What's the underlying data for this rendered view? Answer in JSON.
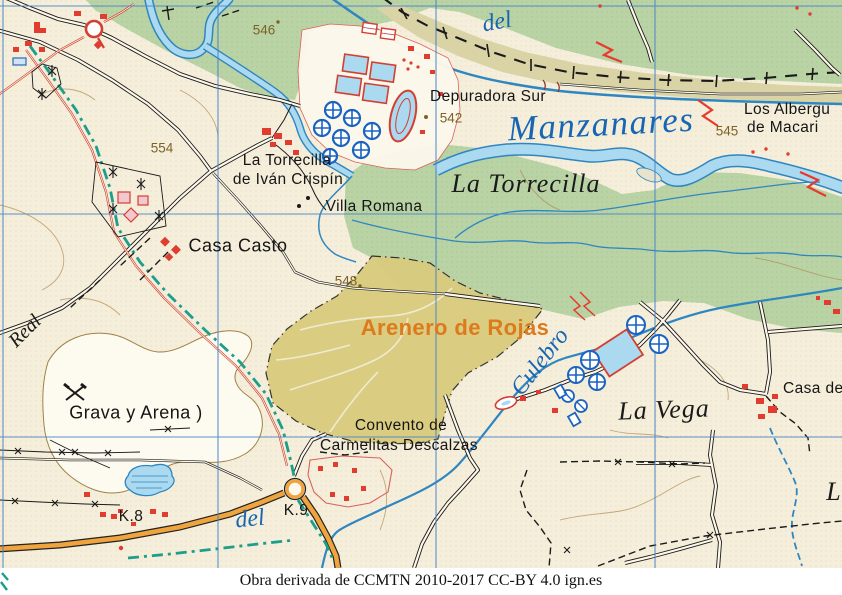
{
  "caption": "Obra derivada de CCMTN 2010-2017 CC-BY 4.0 ign.es",
  "map": {
    "colors": {
      "grid_blue": "#4a86c8",
      "forest_green": "#b9d3a5",
      "scrub_khaki": "#d9d3a6",
      "water_fill": "#abd9ef",
      "water_edge": "#2f86c0",
      "arenero_yellow": "#d8ca7c",
      "road_orange": "#f0a43e",
      "building_red": "#e03c30",
      "via_pecuaria_teal": "#1d9e8a",
      "label_brown": "#7d6228",
      "hydro_blue": "#1766b3",
      "arenero_label_orange": "#dd7a1c"
    },
    "labels": [
      {
        "id": "elev-546",
        "t": "546",
        "x": 264,
        "y": 30,
        "c": "elev"
      },
      {
        "id": "elev-554",
        "t": "554",
        "x": 162,
        "y": 148,
        "c": "elev"
      },
      {
        "id": "elev-542",
        "t": "542",
        "x": 451,
        "y": 118,
        "c": "elev"
      },
      {
        "id": "elev-545",
        "t": "545",
        "x": 727,
        "y": 131,
        "c": "elev"
      },
      {
        "id": "elev-548",
        "t": "548",
        "x": 346,
        "y": 281,
        "c": "elev"
      },
      {
        "id": "depuradora-sur",
        "t": "Depuradora Sur",
        "x": 488,
        "y": 97,
        "c": "topo"
      },
      {
        "id": "la-torrecilla-caserio",
        "t": "La Torrecilla",
        "x": 287,
        "y": 161,
        "c": "topo"
      },
      {
        "id": "de-ivan-crispin",
        "t": "de Iván Crispín",
        "x": 288,
        "y": 180,
        "c": "topo"
      },
      {
        "id": "villa-romana",
        "t": "Villa Romana",
        "x": 374,
        "y": 207,
        "c": "topo"
      },
      {
        "id": "casa-casto",
        "t": "Casa Casto",
        "x": 238,
        "y": 246,
        "c": "topo-lg"
      },
      {
        "id": "los-albergu",
        "t": "Los Albergu",
        "x": 744,
        "y": 110,
        "c": "topo",
        "a": "left"
      },
      {
        "id": "de-macari",
        "t": "de Macari",
        "x": 747,
        "y": 128,
        "c": "topo",
        "a": "left"
      },
      {
        "id": "casa-de",
        "t": "Casa de",
        "x": 783,
        "y": 389,
        "c": "topo",
        "a": "left"
      },
      {
        "id": "convento-de",
        "t": "Convento de",
        "x": 401,
        "y": 426,
        "c": "topo"
      },
      {
        "id": "carmelitas-descalzas",
        "t": "Carmelitas Descalzas",
        "x": 399,
        "y": 446,
        "c": "topo"
      },
      {
        "id": "grava-y-arena",
        "t": "Grava y Arena )",
        "x": 136,
        "y": 413,
        "c": "topo-lg"
      },
      {
        "id": "k8",
        "t": "K.8",
        "x": 131,
        "y": 517,
        "c": "topo"
      },
      {
        "id": "k9",
        "t": "K.9",
        "x": 296,
        "y": 511,
        "c": "topo"
      },
      {
        "id": "arenero-de-rojas",
        "t": "Arenero de Rojas",
        "x": 455,
        "y": 328,
        "c": "arenero"
      },
      {
        "id": "la-torrecilla-paraje",
        "t": "La Torrecilla",
        "x": 526,
        "y": 184,
        "c": "paraje-lg"
      },
      {
        "id": "la-vega",
        "t": "La Vega",
        "x": 664,
        "y": 410,
        "c": "paraje-lg",
        "r": -2
      },
      {
        "id": "l-partial",
        "t": "L",
        "x": 834,
        "y": 492,
        "c": "paraje-lg"
      },
      {
        "id": "real",
        "t": "Real",
        "x": 25,
        "y": 331,
        "c": "paraje-sm",
        "r": -45
      },
      {
        "id": "manzanares",
        "t": "Manzanares",
        "x": 601,
        "y": 124,
        "c": "hydro-lg",
        "r": -3
      },
      {
        "id": "del-top",
        "t": "del",
        "x": 497,
        "y": 22,
        "c": "hydro-md",
        "r": -10
      },
      {
        "id": "del-bottom",
        "t": "del",
        "x": 250,
        "y": 519,
        "c": "hydro-md",
        "r": -6
      },
      {
        "id": "culebro",
        "t": "Culebro",
        "x": 540,
        "y": 362,
        "c": "hydro-md",
        "r": -52
      }
    ]
  }
}
